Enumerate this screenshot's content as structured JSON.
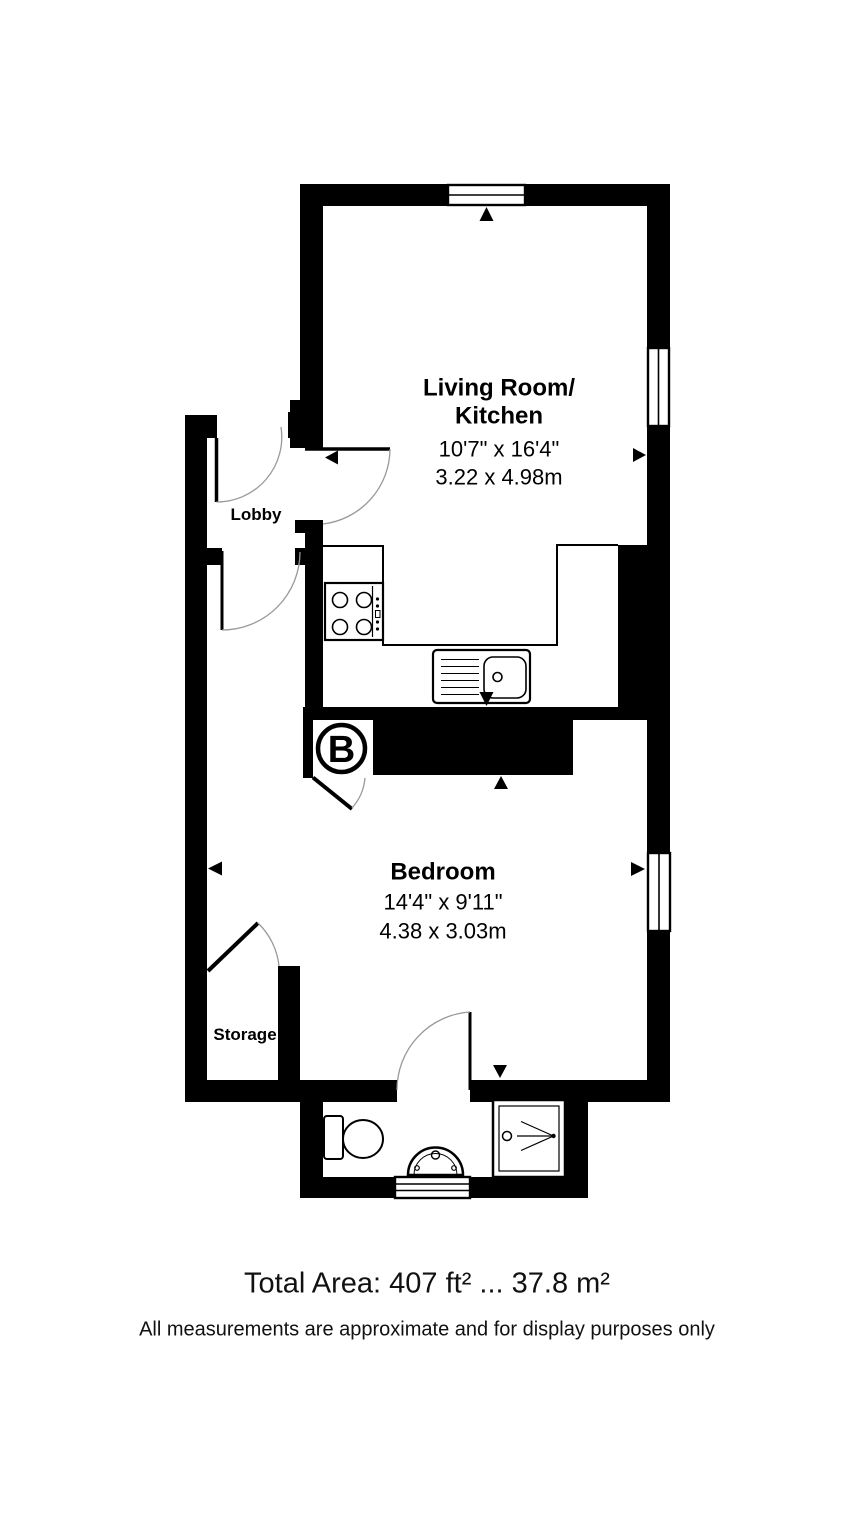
{
  "plan": {
    "rooms": {
      "living_kitchen": {
        "label_line1": "Living Room/",
        "label_line2": "Kitchen",
        "dim_imperial": "10'7\" x 16'4\"",
        "dim_metric": "3.22 x 4.98m"
      },
      "lobby": {
        "label": "Lobby"
      },
      "bedroom": {
        "label": "Bedroom",
        "dim_imperial": "14'4\" x 9'11\"",
        "dim_metric": "4.38 x 3.03m"
      },
      "storage": {
        "label": "Storage"
      }
    },
    "entry_marker": {
      "label": "B"
    },
    "colors": {
      "wall": "#000000",
      "floor": "#ffffff",
      "door_arc": "#999999",
      "text": "#111111"
    }
  },
  "footer": {
    "total_area": "Total Area: 407 ft² ... 37.8 m²",
    "disclaimer": "All measurements are approximate and for display purposes only"
  }
}
